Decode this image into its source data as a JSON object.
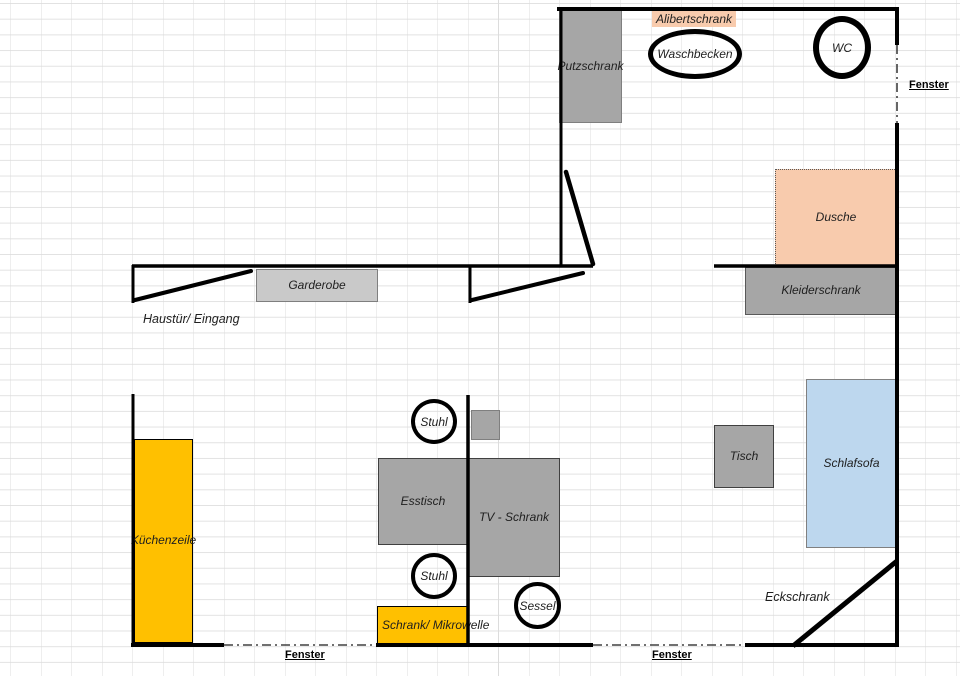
{
  "floorplan": {
    "colors": {
      "furniture_gray": "#a6a6a6",
      "light_gray": "#c9c9c9",
      "peach": "#f8cbad",
      "orange": "#ffc000",
      "light_blue": "#bdd7ee",
      "wall": "#000000",
      "grid": "#dcdcdc",
      "text": "#1f1f1f"
    },
    "furniture": [
      {
        "id": "putzschrank",
        "label": "Putzschrank",
        "x": 559,
        "y": 10,
        "w": 63,
        "h": 113,
        "fill": "#a6a6a6",
        "bcolor": "#7f7f7f",
        "bw": 1,
        "bstyle": "solid",
        "nowrap": true
      },
      {
        "id": "garderobe",
        "label": "Garderobe",
        "x": 256,
        "y": 269,
        "w": 122,
        "h": 33,
        "fill": "#c9c9c9",
        "bcolor": "#7f7f7f",
        "bw": 1,
        "bstyle": "solid"
      },
      {
        "id": "dusche",
        "label": "Dusche",
        "x": 775,
        "y": 169,
        "w": 122,
        "h": 97,
        "fill": "#f8cbad",
        "bcolor": "#595959",
        "bw": 1,
        "bstyle": "dotted"
      },
      {
        "id": "kleiderschrank",
        "label": "Kleiderschrank",
        "x": 745,
        "y": 267,
        "w": 152,
        "h": 48,
        "fill": "#a6a6a6",
        "bcolor": "#595959",
        "bw": 1,
        "bstyle": "solid"
      },
      {
        "id": "schlafsofa",
        "label": "Schlafsofa",
        "x": 806,
        "y": 379,
        "w": 91,
        "h": 169,
        "fill": "#bdd7ee",
        "bcolor": "#808080",
        "bw": 1,
        "bstyle": "solid"
      },
      {
        "id": "tisch",
        "label": "Tisch",
        "x": 714,
        "y": 425,
        "w": 60,
        "h": 63,
        "fill": "#a6a6a6",
        "bcolor": "#404040",
        "bw": 1.5,
        "bstyle": "solid"
      },
      {
        "id": "esstisch",
        "label": "Esstisch",
        "x": 378,
        "y": 458,
        "w": 90,
        "h": 87,
        "fill": "#a6a6a6",
        "bcolor": "#404040",
        "bw": 1.5,
        "bstyle": "solid"
      },
      {
        "id": "tv-schrank",
        "label": "TV - Schrank",
        "x": 468,
        "y": 458,
        "w": 92,
        "h": 119,
        "fill": "#a6a6a6",
        "bcolor": "#404040",
        "bw": 1.5,
        "bstyle": "solid"
      },
      {
        "id": "side-square",
        "label": "",
        "x": 471,
        "y": 410,
        "w": 29,
        "h": 30,
        "fill": "#a6a6a6",
        "bcolor": "#7f7f7f",
        "bw": 1,
        "bstyle": "solid"
      },
      {
        "id": "kuechenzeile",
        "label": "Küchenzeile",
        "x": 134,
        "y": 439,
        "w": 59,
        "h": 204,
        "fill": "#ffc000",
        "bcolor": "#000000",
        "bw": 1.5,
        "bstyle": "solid",
        "nowrap": true
      },
      {
        "id": "schrank-mikrowelle",
        "label": "Schrank/\nMikrowelle",
        "x": 377,
        "y": 606,
        "w": 91,
        "h": 39,
        "fill": "#ffc000",
        "bcolor": "#000000",
        "bw": 1.5,
        "bstyle": "solid",
        "align": "left",
        "nowrap": true
      }
    ],
    "circles": [
      {
        "id": "waschbecken",
        "label": "Waschbecken",
        "x": 648,
        "y": 29,
        "w": 94,
        "h": 50,
        "sw": 5
      },
      {
        "id": "wc",
        "label": "WC",
        "x": 813,
        "y": 16,
        "w": 58,
        "h": 63,
        "sw": 6
      },
      {
        "id": "stuhl-1",
        "label": "Stuhl",
        "x": 411,
        "y": 399,
        "w": 46,
        "h": 45,
        "sw": 4.5
      },
      {
        "id": "stuhl-2",
        "label": "Stuhl",
        "x": 411,
        "y": 553,
        "w": 46,
        "h": 46,
        "sw": 4.5
      },
      {
        "id": "sessel",
        "label": "Sessel",
        "x": 514,
        "y": 582,
        "w": 47,
        "h": 47,
        "sw": 4.5
      }
    ],
    "annotations": [
      {
        "id": "alibertschrank",
        "label": "Alibertschrank",
        "x": 652,
        "y": 11,
        "style": "highlight",
        "bg": "#f8cbad"
      },
      {
        "id": "haustuer-eingang",
        "label": "Haustür/ Eingang",
        "x": 143,
        "y": 312,
        "style": "plain"
      },
      {
        "id": "eckschrank",
        "label": "Eckschrank",
        "x": 765,
        "y": 590,
        "style": "plain"
      },
      {
        "id": "fenster-right",
        "label": "Fenster",
        "x": 909,
        "y": 79,
        "style": "window"
      },
      {
        "id": "fenster-bottom-left",
        "label": "Fenster",
        "x": 285,
        "y": 649,
        "style": "window"
      },
      {
        "id": "fenster-bottom-center",
        "label": "Fenster",
        "x": 652,
        "y": 649,
        "style": "window"
      }
    ]
  }
}
